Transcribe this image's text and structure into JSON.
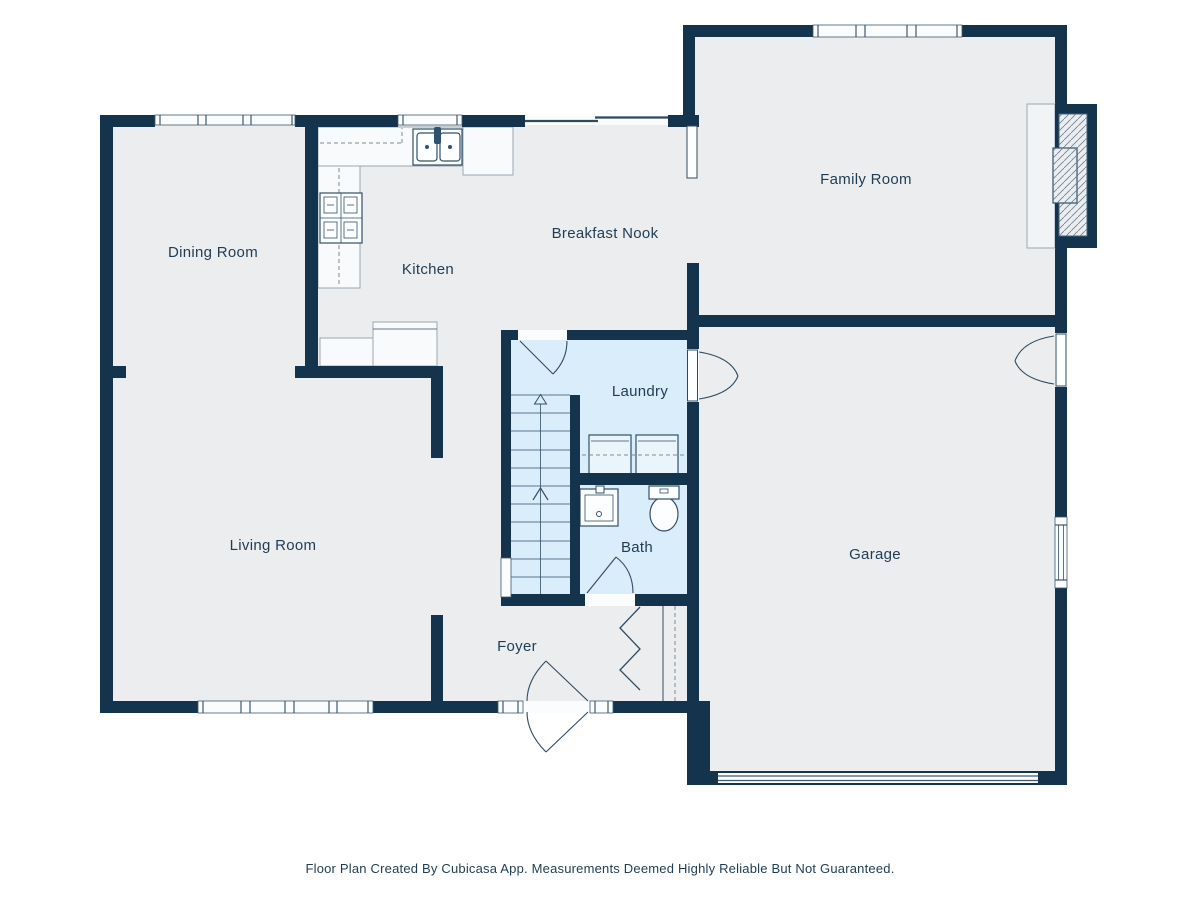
{
  "caption": "Floor Plan Created By Cubicasa App. Measurements Deemed Highly Reliable But Not Guaranteed.",
  "colors": {
    "wall": "#14344E",
    "floor": "#ECEDEF",
    "wet_room": "#D9EDFB",
    "fixture_fill": "#F8FAFB",
    "fixture_stroke": "#31506B",
    "counter_stroke": "#9AA7B2",
    "label_text": "#1F3C55",
    "hatch": "#6C8196"
  },
  "rooms": [
    {
      "id": "dining-room",
      "label": "Dining Room"
    },
    {
      "id": "kitchen",
      "label": "Kitchen"
    },
    {
      "id": "breakfast-nook",
      "label": "Breakfast Nook"
    },
    {
      "id": "family-room",
      "label": "Family Room"
    },
    {
      "id": "laundry",
      "label": "Laundry"
    },
    {
      "id": "living-room",
      "label": "Living Room"
    },
    {
      "id": "bath",
      "label": "Bath"
    },
    {
      "id": "foyer",
      "label": "Foyer"
    },
    {
      "id": "garage",
      "label": "Garage"
    }
  ],
  "fixtures": [
    "kitchen-sink",
    "stove",
    "kitchen-counter",
    "peninsula-counter",
    "washer",
    "dryer",
    "bathroom-sink",
    "toilet",
    "staircase",
    "fireplace",
    "closet-bifold-doors",
    "entry-door",
    "garage-door",
    "sliding-door"
  ]
}
